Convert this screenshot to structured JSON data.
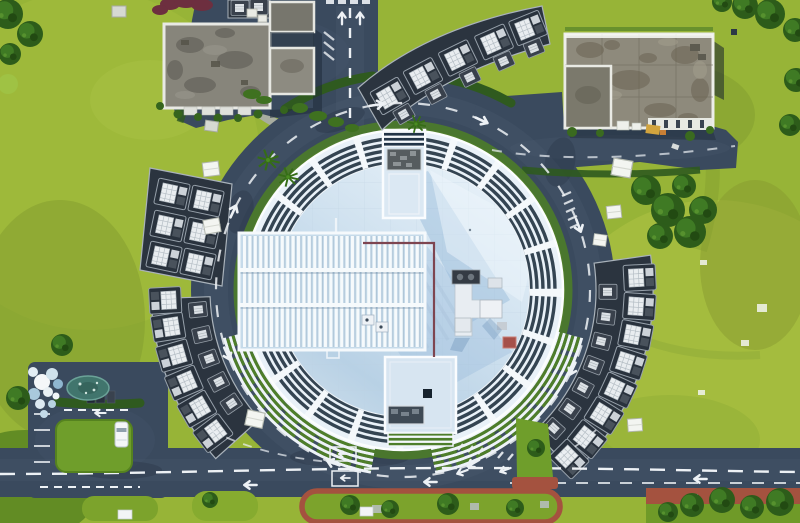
{
  "scene": {
    "type": "aerial-drone-photograph",
    "description": "Nadir aerial photograph of a large circular exhibition hall with a white louvered perimeter ring and pale blue roof, encircled by a dark asphalt ring road. Curved clusters of dark-roofed service annexes with white rooftop HVAC units follow the ring on four sides. A weathered grey-roofed office building sits at the top-left and another at the top-right, set in bright yellow-green lawns with winding stone paths, palm trees, a small parking lot with a white van at the lower left, and a horizontal boulevard with red-brick sidewalk islands along the bottom.",
    "time_of_day": "daytime",
    "lighting": "sun from upper-left, shadows cast to lower-right",
    "visible_text": "none"
  },
  "palette": {
    "grass": "#97b437",
    "grass_light": "#aabf41",
    "grass_olive": "#7e9a2e",
    "grass_dark": "#55821f",
    "tree_green": "#2d5c1a",
    "asphalt": "#3a4a5e",
    "asphalt_worn": "#4e5f74",
    "roof_white": "#eef4f9",
    "roof_pale_blue": "#cfe1ef",
    "roof_shadow_blue": "#8fb4d6",
    "louver_slot_dark": "#20313f",
    "terrace_green": "#4e7e2a",
    "hedge_green": "#4c7c29",
    "annex_roof_dark": "#29323d",
    "hvac_white": "#e9edf0",
    "concrete_roof_grey": "#8e8a7c",
    "brick_red": "#a4523f",
    "road_marking_white": "#edf1f5",
    "service_pipe_maroon": "#7e4550",
    "pond_teal": "#41756d",
    "equipment_yellow": "#d2a43e",
    "van_white": "#f4f6f8"
  },
  "inventory": {
    "central_hall": {
      "shape": "circle",
      "louver_ring_segments": 20,
      "rooftop_structures": [
        "vent-tower-north",
        "plant-room-south",
        "hvac-cluster-east",
        "maroon-service-pipe",
        "louvered-hall-west"
      ],
      "terrace_steps": "white concentric stairs with green planted strips on south side"
    },
    "annex_clusters": [
      {
        "id": "north",
        "large_units": 5,
        "small_units": 5
      },
      {
        "id": "west",
        "large_units": 6,
        "small_units": 0
      },
      {
        "id": "southwest",
        "large_units": 6,
        "small_units": 5
      },
      {
        "id": "southeast",
        "large_units": 8,
        "small_units": 7
      }
    ],
    "buildings": [
      {
        "id": "office-northwest",
        "roof": "dark weathered concrete, white parapet, two wings"
      },
      {
        "id": "office-northeast",
        "roof": "weathered grey concrete with grid joints, white parapet, lower annex"
      }
    ],
    "roads": [
      "ring-road",
      "north-approach-road",
      "northeast-driveway",
      "south-boulevard",
      "southwest-parking-lot"
    ],
    "vehicles": [
      {
        "id": "white-van",
        "location": "southwest parking lot"
      }
    ],
    "landscape": [
      "stone-footpath-northwest",
      "palm-trees",
      "tree-cluster-east",
      "teal-pond",
      "white-debris-pile",
      "red-brick-sidewalk-islands"
    ]
  }
}
